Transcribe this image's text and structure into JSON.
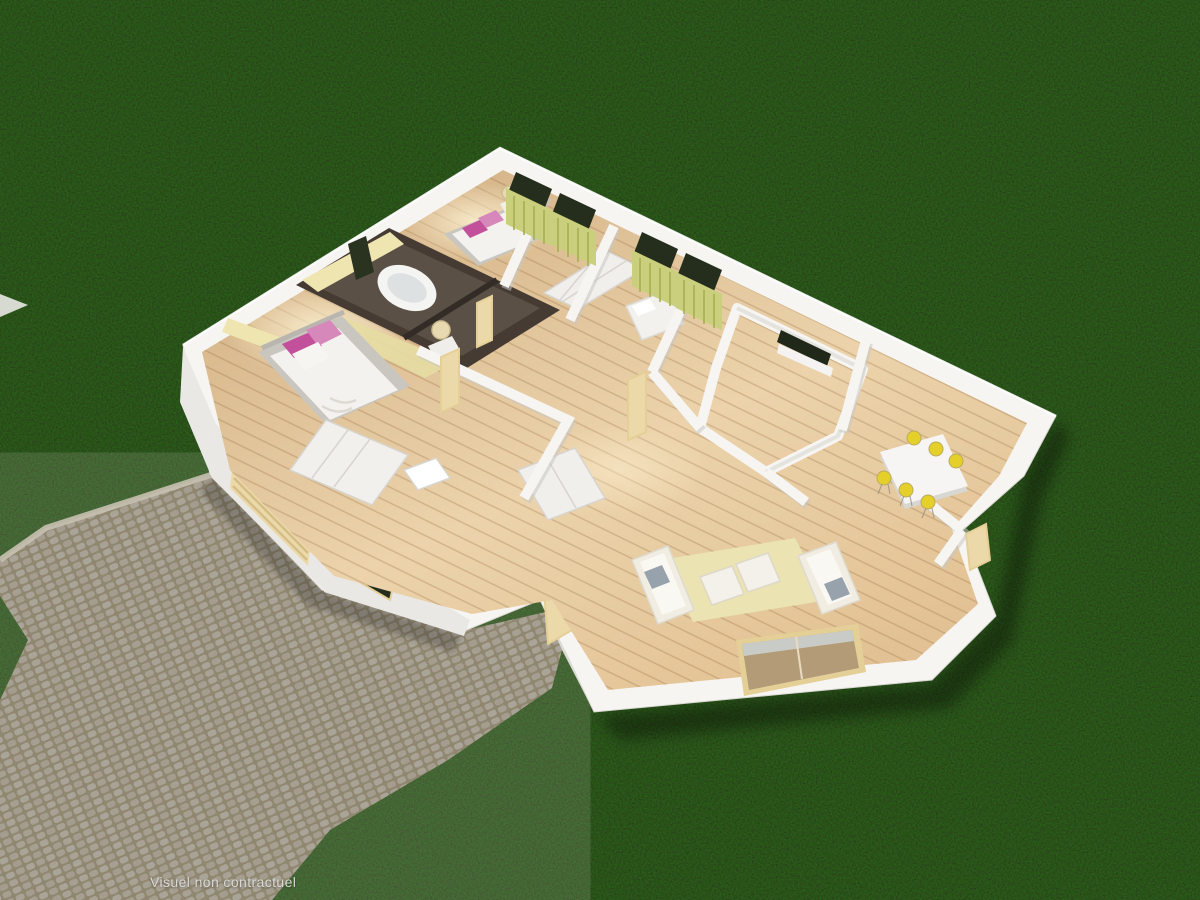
{
  "caption": {
    "text": "Visuel non contractuel"
  },
  "scene": {
    "type": "3d-dollhouse-floor-plan-render",
    "view": "aerial cutaway of single-storey house interior over dark lawn",
    "ground": "dark green grass with cobblestone driveway and curved footpath to porch",
    "rooms": [
      "bedroom-1",
      "bedroom-2",
      "bedroom-3",
      "bathroom",
      "wc",
      "dressing",
      "hallway",
      "foyer",
      "dining-area",
      "living-room",
      "kitchen-corner",
      "garage",
      "porch"
    ],
    "furniture": [
      "double-bed-with-pink-pillows-bedroom-1",
      "double-bed-with-pink-pillows-bedroom-2",
      "low-white-bed-bedroom-3",
      "oval-bathtub",
      "white-dining-table-with-6-yellow-chairs",
      "two-white-sofas",
      "two-white-ottomans",
      "cream-rug",
      "white-wardrobes",
      "bedside-lamps",
      "green-curtains",
      "garage-door"
    ]
  },
  "palette": {
    "grass_base": "#1b2812",
    "cobble_grout": "#867b61",
    "cobble_stone": "#a59f92",
    "curb": "#c8c1b1",
    "wall_white": "#f6f5f2",
    "wall_face": "#eae8e4",
    "wall_shade": "#dcdad5",
    "floor_wood": "#d4b286",
    "floor_wood_light": "#ecd3ab",
    "bath_wall": "#453b33",
    "bath_floor": "#5a5046",
    "accent_yellow": "#efe5b0",
    "curtain_green": "#c9cf7d",
    "curtain_green_deep": "#aab055",
    "glass_dark": "#252d1c",
    "pillow_pink_a": "#c2509b",
    "pillow_pink_b": "#d788bb",
    "bed_white": "#f4f2ee",
    "platform_gray": "#c9c6c0",
    "chair_yellow": "#e5cf2b",
    "rug_cream": "#ebe3b2",
    "sofa_white": "#f1ede3",
    "cushion_gray": "#98a2ac",
    "door_beige": "#ecd9a9",
    "door_frame": "#e4cf96",
    "caption_color": "#d8d8d4"
  }
}
